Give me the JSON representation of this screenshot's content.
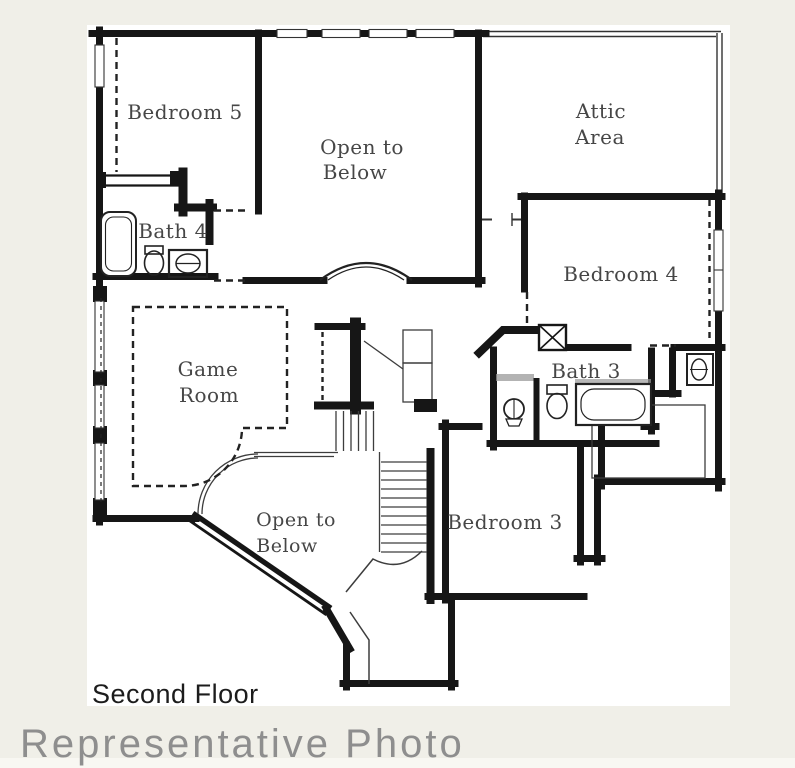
{
  "colors": {
    "background": "#f0efe8",
    "paper": "#ffffff",
    "wall": "#161616",
    "thin_line": "#3d3d3d",
    "dash_line": "#222222",
    "fixture_gray": "#9a9a9a",
    "label": "#464646",
    "title": "#1c1c1c",
    "watermark": "#8e8e8e"
  },
  "labels": {
    "bedroom5": "Bedroom 5",
    "open_to_below_upper_line1": "Open to",
    "open_to_below_upper_line2": "Below",
    "attic_line1": "Attic",
    "attic_line2": "Area",
    "bath4": "Bath 4",
    "bedroom4": "Bedroom 4",
    "game_room_line1": "Game",
    "game_room_line2": "Room",
    "bath3": "Bath 3",
    "open_to_below_lower_line1": "Open to",
    "open_to_below_lower_line2": "Below",
    "bedroom3": "Bedroom 3"
  },
  "title": "Second Floor",
  "watermark": "Representative Photo"
}
